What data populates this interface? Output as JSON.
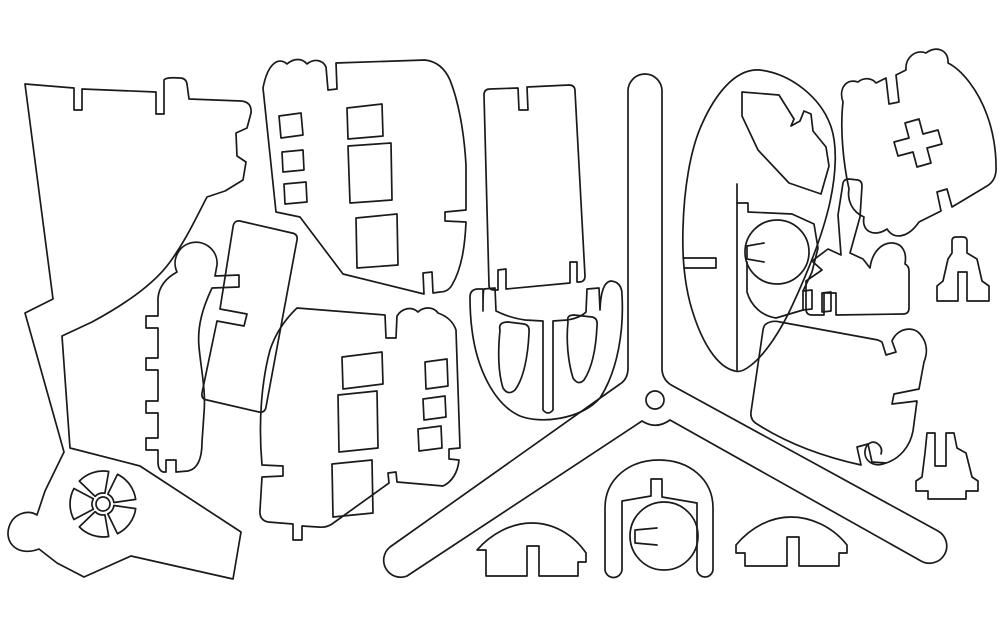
{
  "drawing": {
    "title": "Laser-cut parts layout - helicopter 3D puzzle pattern (outline cut paths on white sheet)",
    "background_color": "#ffffff",
    "line_color": "#1a1a1a",
    "canvas_width": 1002,
    "canvas_height": 633,
    "parts": [
      {
        "label": "left-fuselage-panel-with-wheel"
      },
      {
        "label": "spoked-wheel-cutout"
      },
      {
        "label": "comb-frame-with-knob"
      },
      {
        "label": "slanted-strut"
      },
      {
        "label": "upper-window-panel"
      },
      {
        "label": "lower-window-panel"
      },
      {
        "label": "tail-boom-plate"
      },
      {
        "label": "hull-bottom-with-cutouts"
      },
      {
        "label": "three-blade-rotor"
      },
      {
        "label": "cabin-egg-with-cutouts"
      },
      {
        "label": "rounded-plate-with-cross-hole"
      },
      {
        "label": "bracket-piece"
      },
      {
        "label": "small-crown-piece-top"
      },
      {
        "label": "seat-panel-with-hook"
      },
      {
        "label": "small-crown-piece-mid"
      },
      {
        "label": "arch-horseshoe"
      },
      {
        "label": "keyed-disc"
      },
      {
        "label": "dome-skid-left"
      },
      {
        "label": "dome-skid-right"
      }
    ]
  }
}
